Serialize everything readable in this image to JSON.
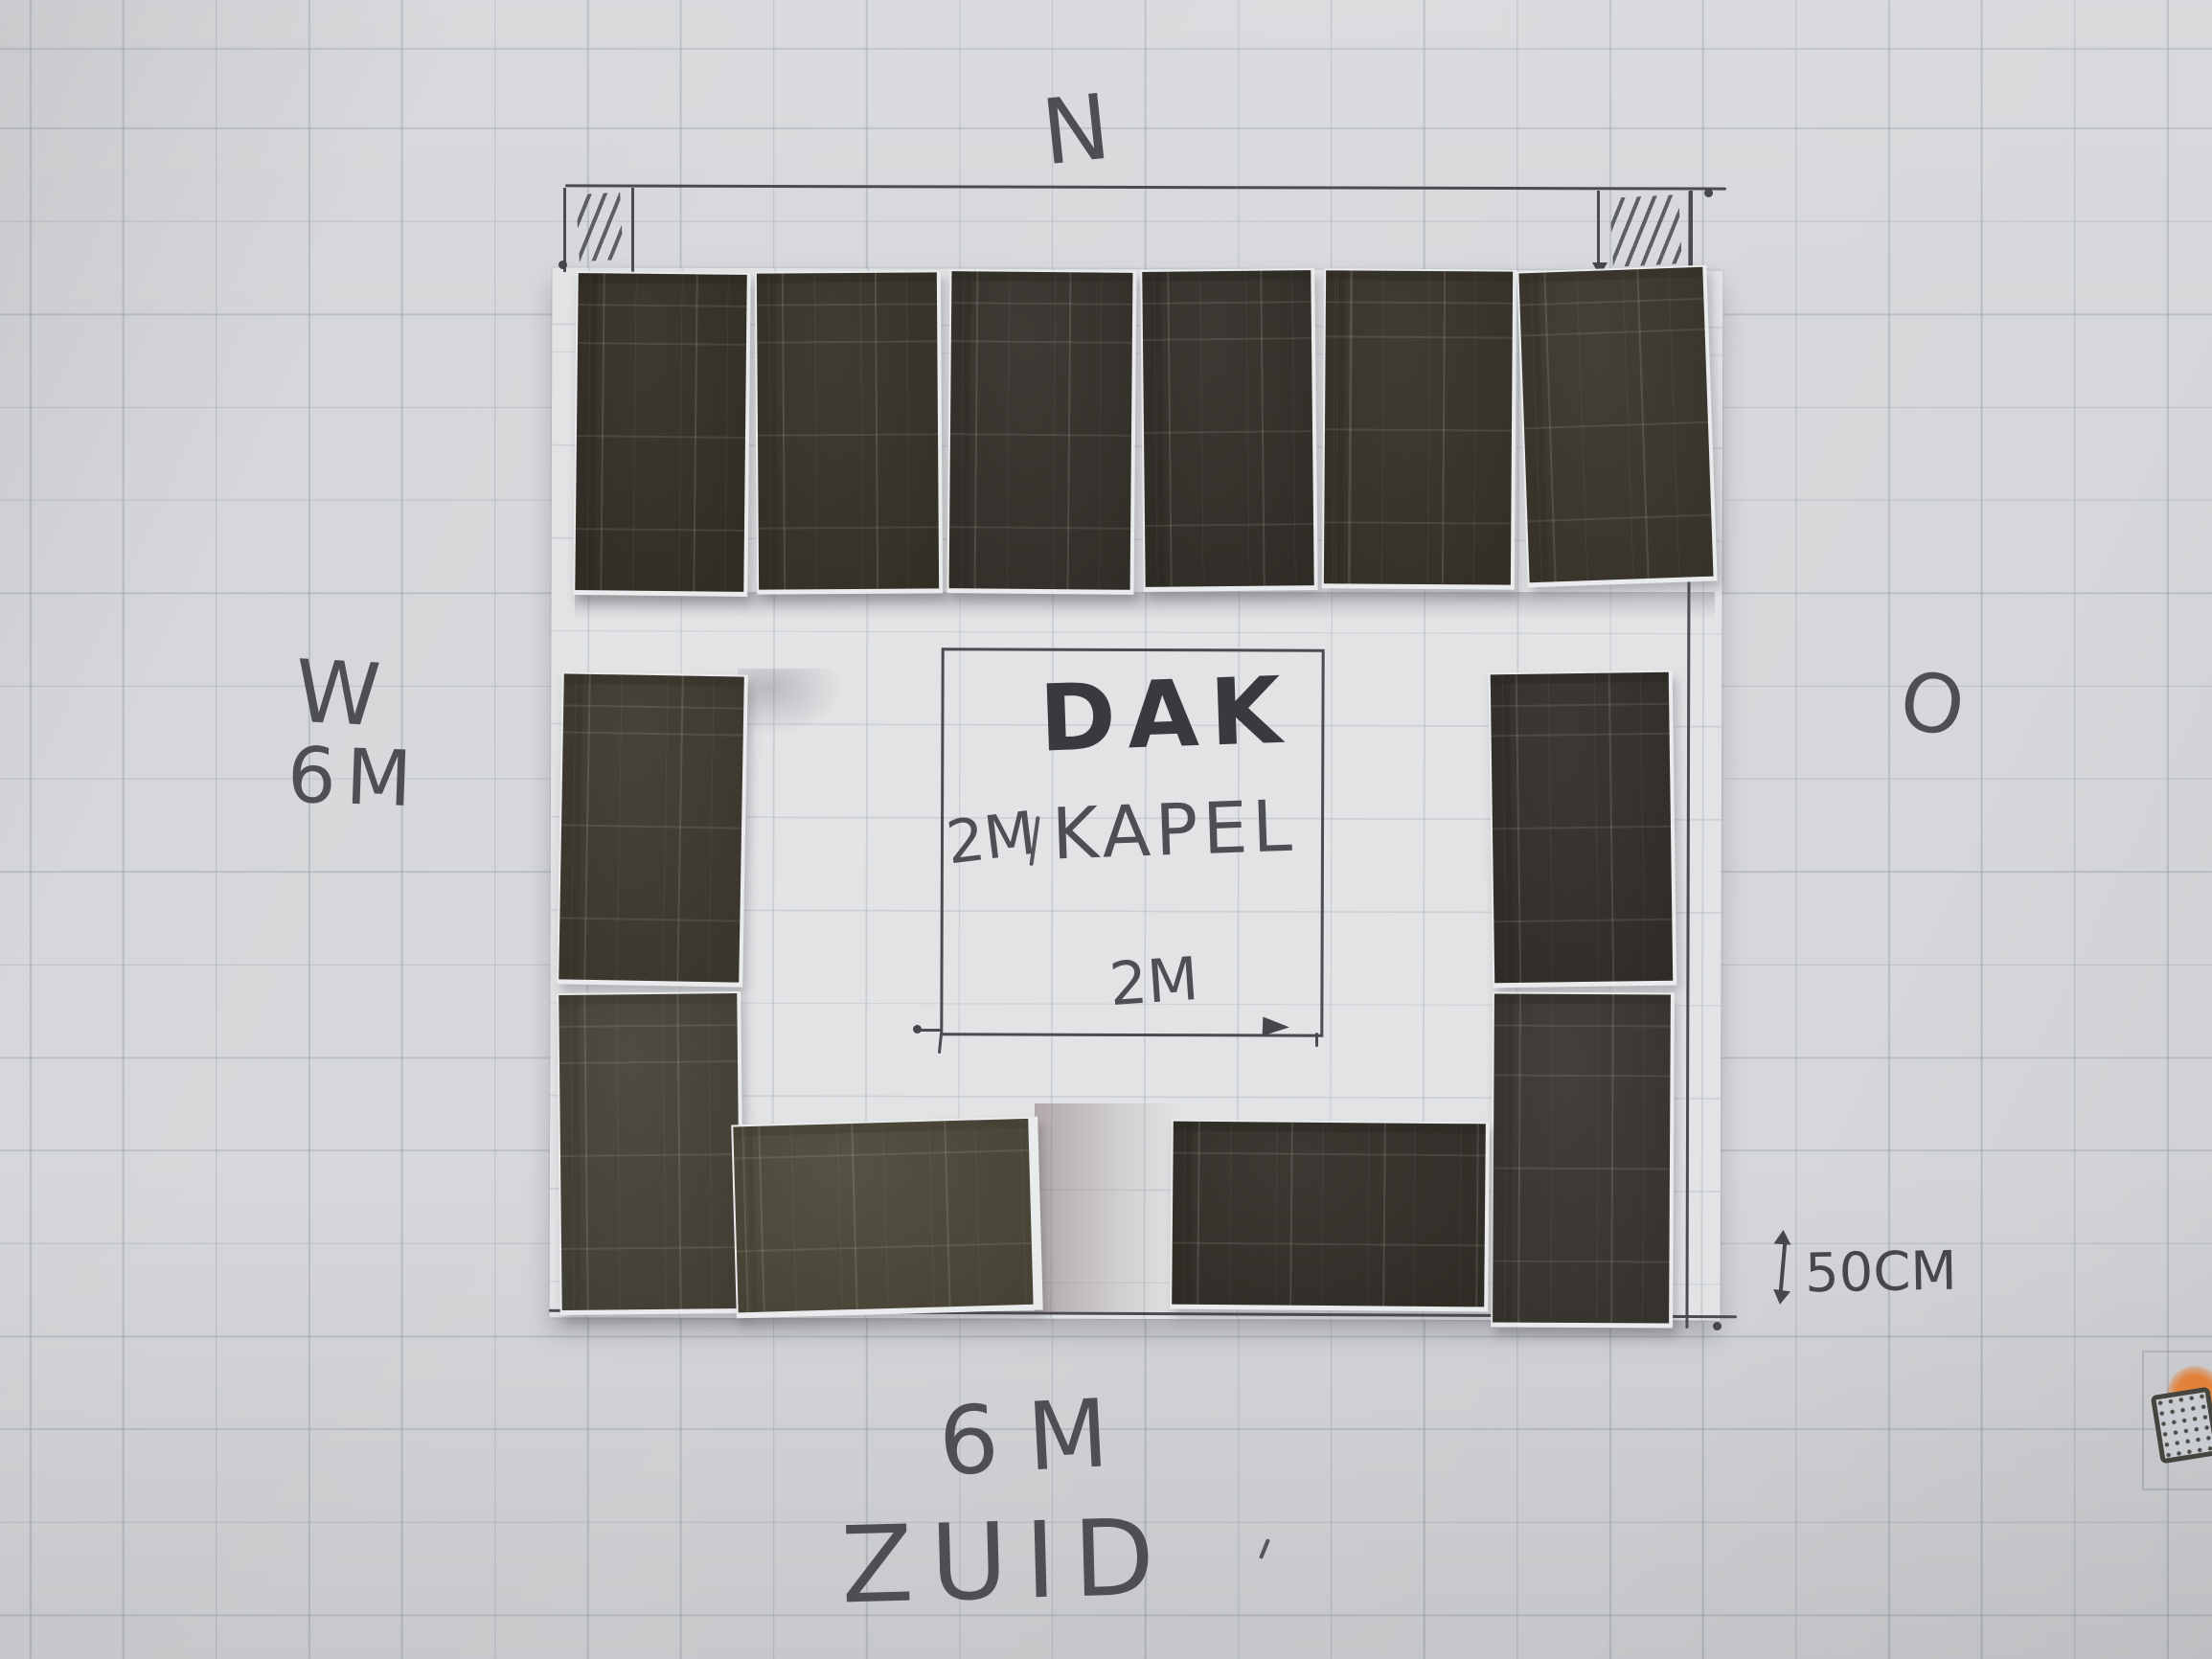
{
  "scene": {
    "description": "Photo of a hand-drawn roof plan on graph paper: paper solar-panel cut-outs arranged around a central dormer (dakkapel) square",
    "compass": {
      "top": "N",
      "left": "W",
      "right": "O",
      "bottom": "ZUID"
    },
    "dimensions": {
      "west_side": "6M",
      "south_side": "6M",
      "dormer_width": "2M",
      "dormer_height": "2M",
      "edge_offset": "50CM"
    },
    "dormer": {
      "line1": "DAK",
      "line2": "KAPEL"
    },
    "panels": {
      "top_row": 6,
      "west_column": 2,
      "east_column": 2,
      "south_row": 2,
      "total": 12
    }
  },
  "labels": {
    "north": "N",
    "west": "W",
    "west_dim": "6M",
    "east": "O",
    "south_dim": "6M",
    "south": "ZUID",
    "dormer_line1": "DAK",
    "dormer_dim_left": "2M",
    "dormer_line2": "KAPEL",
    "dormer_dim_bottom": "2M",
    "offset": "50CM"
  },
  "colors": {
    "paper": "#d5d7da",
    "grid_line": "#9aa0a8",
    "pencil": "#4b4c52",
    "panel_dark": "#37332b",
    "panel_backing": "#eaebec",
    "sun_logo": "#e2813a"
  }
}
